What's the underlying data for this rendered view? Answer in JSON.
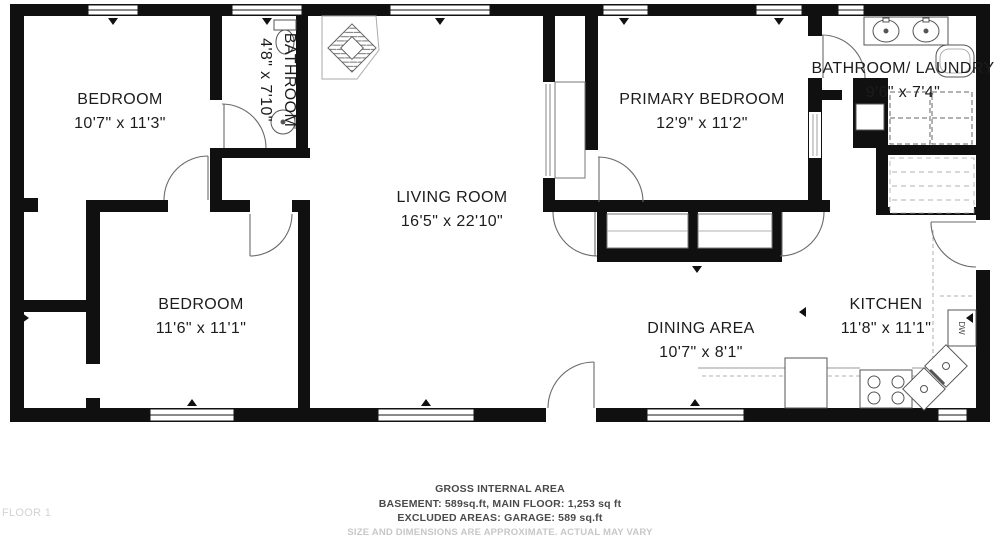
{
  "floor_plan": {
    "rooms": [
      {
        "id": "bedroom-1",
        "name": "BEDROOM",
        "dimensions": "10'7\" x 11'3\""
      },
      {
        "id": "bathroom",
        "name": "BATHROOM",
        "dimensions": "4'8\" x 7'10\""
      },
      {
        "id": "living-room",
        "name": "LIVING ROOM",
        "dimensions": "16'5\" x 22'10\""
      },
      {
        "id": "primary-bedroom",
        "name": "PRIMARY BEDROOM",
        "dimensions": "12'9\" x 11'2\""
      },
      {
        "id": "bathroom-laundry",
        "name": "BATHROOM/ LAUNDRY",
        "dimensions": "9'6\" x 7'4\""
      },
      {
        "id": "bedroom-2",
        "name": "BEDROOM",
        "dimensions": "11'6\" x 11'1\""
      },
      {
        "id": "dining-area",
        "name": "DINING AREA",
        "dimensions": "10'7\" x 8'1\""
      },
      {
        "id": "kitchen",
        "name": "KITCHEN",
        "dimensions": "11'8\" x 11'1\""
      }
    ],
    "fixtures": {
      "dishwasher_label": "DW"
    },
    "colors": {
      "walls": "#101010",
      "background": "#ffffff",
      "fixture_line": "#5a5a5a",
      "muted_text": "#c7c7c7"
    }
  },
  "footer": {
    "title": "GROSS INTERNAL AREA",
    "line1": "BASEMENT: 589sq.ft, MAIN FLOOR: 1,253 sq ft",
    "line2": "EXCLUDED AREAS: GARAGE:  589  sq.ft",
    "disclaimer": "SIZE AND DIMENSIONS ARE APPROXIMATE, ACTUAL MAY VARY",
    "floor_label": "FLOOR 1"
  }
}
